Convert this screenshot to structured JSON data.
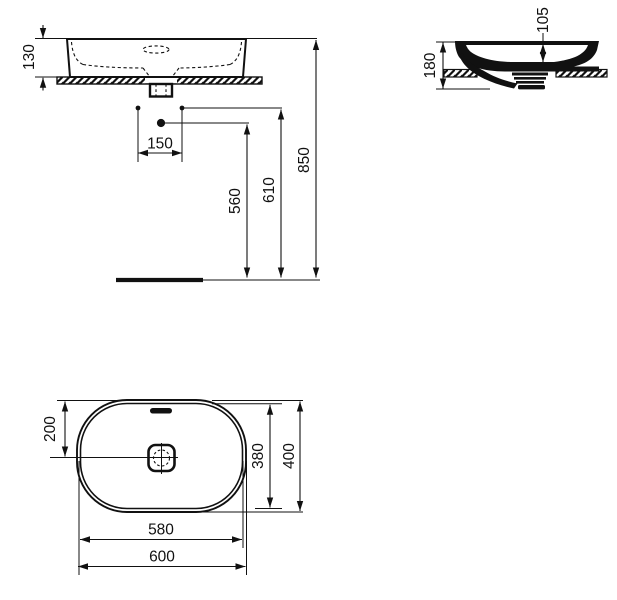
{
  "dimensions": {
    "front_basin_height": "130",
    "front_tap_hole_spacing": "150",
    "front_spout_height": "560",
    "front_tap_hole_height": "610",
    "front_rim_height": "850",
    "side_overall_height": "180",
    "side_bowl_depth": "105",
    "plan_drain_offset": "200",
    "plan_inner_depth": "380",
    "plan_overall_depth": "400",
    "plan_inner_width": "580",
    "plan_overall_width": "600"
  },
  "colors": {
    "line": "#111111",
    "background": "#ffffff"
  }
}
